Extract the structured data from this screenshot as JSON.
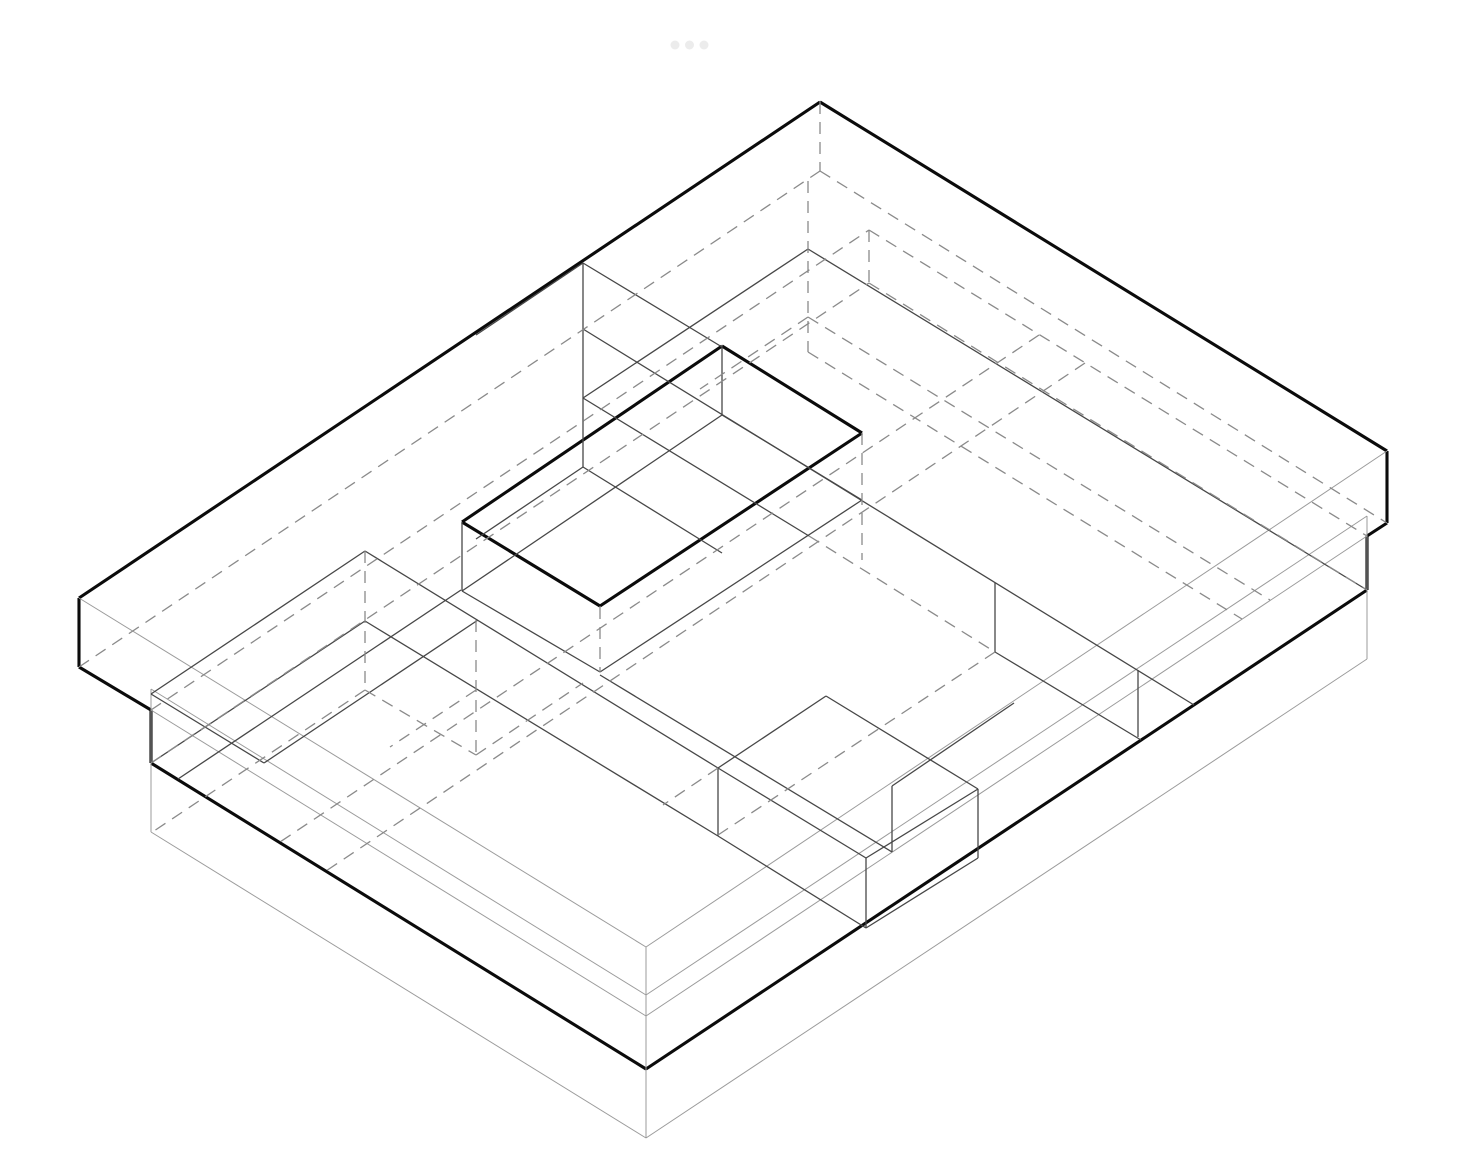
{
  "canvas": {
    "width": 1470,
    "height": 1154,
    "background": "#ffffff"
  },
  "drawing": {
    "kind": "architectural-axonometric-line-diagram",
    "description": "Stepped stack of rectangular slabs (roof slab, floor slab, plinth) with a bold rectangular opening cut in the roof and x-ray interior volumes; hidden edges dashed."
  },
  "window_dots": {
    "color": "#ececec",
    "radius": 4.5,
    "cy": 45,
    "cx": [
      675,
      689.5,
      704
    ]
  },
  "styles": {
    "bold": {
      "stroke": "#0b0b0b",
      "width": 3.1,
      "dash": null
    },
    "dark": {
      "stroke": "#474747",
      "width": 1.3,
      "dash": null
    },
    "light": {
      "stroke": "#9b9b9b",
      "width": 1.0,
      "dash": null
    },
    "dashed": {
      "stroke": "#8a8a8a",
      "width": 1.3,
      "dash": "12 8"
    }
  },
  "groups": [
    {
      "name": "silhouette-and-roof-opening-bold-edges",
      "style": "bold",
      "segments": [
        [
          820,
          102,
          1387,
          451
        ],
        [
          820,
          102,
          79,
          598
        ],
        [
          79,
          598,
          79,
          667
        ],
        [
          1387,
          451,
          1387,
          523
        ],
        [
          79,
          667,
          151,
          710
        ],
        [
          1387,
          523,
          1367,
          536
        ],
        [
          151,
          710,
          151,
          763
        ],
        [
          1367,
          536,
          1367,
          590
        ],
        [
          151,
          763,
          646,
          1069
        ],
        [
          1367,
          590,
          646,
          1069
        ],
        [
          462,
          522,
          722,
          346
        ],
        [
          722,
          346,
          862,
          433
        ],
        [
          462,
          522,
          600,
          606
        ],
        [
          600,
          606,
          862,
          433
        ]
      ]
    },
    {
      "name": "slab-visible-edges-light",
      "style": "light",
      "segments": [
        [
          79,
          598,
          646,
          947
        ],
        [
          1387,
          451,
          646,
          947
        ],
        [
          646,
          947,
          646,
          1138
        ],
        [
          151,
          710,
          646,
          1016
        ],
        [
          1367,
          536,
          646,
          1016
        ],
        [
          151,
          689,
          151,
          832
        ],
        [
          1367,
          516,
          1367,
          659
        ],
        [
          151,
          832,
          646,
          1138
        ],
        [
          646,
          1138,
          1367,
          659
        ],
        [
          151,
          689,
          646,
          995
        ],
        [
          646,
          995,
          1367,
          516
        ]
      ]
    },
    {
      "name": "interior-volumes-and-opening-reveal-edges",
      "style": "dark",
      "segments": [
        [
          462,
          522,
          462,
          591
        ],
        [
          722,
          346,
          722,
          415
        ],
        [
          462,
          591,
          722,
          415
        ],
        [
          722,
          415,
          862,
          500
        ],
        [
          462,
          591,
          600,
          672
        ],
        [
          600,
          672,
          862,
          500
        ],
        [
          461,
          590,
          178,
          779
        ],
        [
          365,
          551,
          151,
          694
        ],
        [
          151,
          694,
          264,
          763
        ],
        [
          264,
          763,
          478,
          620
        ],
        [
          365,
          621,
          151,
          763
        ],
        [
          365,
          551,
          718,
          768
        ],
        [
          365,
          621,
          718,
          836
        ],
        [
          583,
          263,
          583,
          467
        ],
        [
          583,
          263,
          722,
          347
        ],
        [
          583,
          263,
          476,
          335
        ],
        [
          583,
          467,
          476,
          539
        ],
        [
          583,
          467,
          722,
          553
        ],
        [
          583,
          329,
          1194,
          705
        ],
        [
          583,
          398,
          809,
          536
        ],
        [
          808,
          249,
          583,
          398
        ],
        [
          808,
          249,
          1367,
          590
        ],
        [
          995,
          652,
          1141,
          740
        ],
        [
          995,
          583,
          995,
          652
        ],
        [
          1138,
          670,
          1138,
          737
        ],
        [
          718,
          768,
          826,
          696
        ],
        [
          826,
          696,
          978,
          789
        ],
        [
          718,
          768,
          866,
          858
        ],
        [
          866,
          858,
          978,
          789
        ],
        [
          866,
          858,
          866,
          928
        ],
        [
          978,
          789,
          978,
          858
        ],
        [
          718,
          836,
          866,
          928
        ],
        [
          866,
          928,
          978,
          858
        ],
        [
          718,
          768,
          718,
          836
        ],
        [
          892,
          786,
          892,
          852
        ],
        [
          600,
          675,
          892,
          852
        ],
        [
          892,
          786,
          1014,
          703
        ]
      ]
    },
    {
      "name": "hidden-edges-dashed",
      "style": "dashed",
      "segments": [
        [
          820,
          102,
          820,
          171
        ],
        [
          79,
          667,
          820,
          171
        ],
        [
          820,
          171,
          1387,
          523
        ],
        [
          151,
          710,
          869,
          230
        ],
        [
          869,
          230,
          1367,
          536
        ],
        [
          869,
          230,
          869,
          283
        ],
        [
          151,
          763,
          869,
          283
        ],
        [
          869,
          283,
          1367,
          590
        ],
        [
          862,
          433,
          862,
          560
        ],
        [
          600,
          607,
          600,
          672
        ],
        [
          365,
          551,
          365,
          690
        ],
        [
          476,
          620,
          476,
          755
        ],
        [
          365,
          690,
          476,
          755
        ],
        [
          365,
          690,
          151,
          833
        ],
        [
          476,
          755,
          583,
          683
        ],
        [
          476,
          690,
          390,
          747
        ],
        [
          808,
          181,
          808,
          352
        ],
        [
          808,
          317,
          1270,
          600
        ],
        [
          808,
          352,
          1242,
          619
        ],
        [
          808,
          317,
          700,
          389
        ],
        [
          809,
          536,
          995,
          652
        ],
        [
          995,
          652,
          718,
          835
        ],
        [
          718,
          768,
          663,
          805
        ],
        [
          1039,
          335,
          280,
          842
        ],
        [
          1085,
          363,
          326,
          871
        ]
      ]
    }
  ]
}
